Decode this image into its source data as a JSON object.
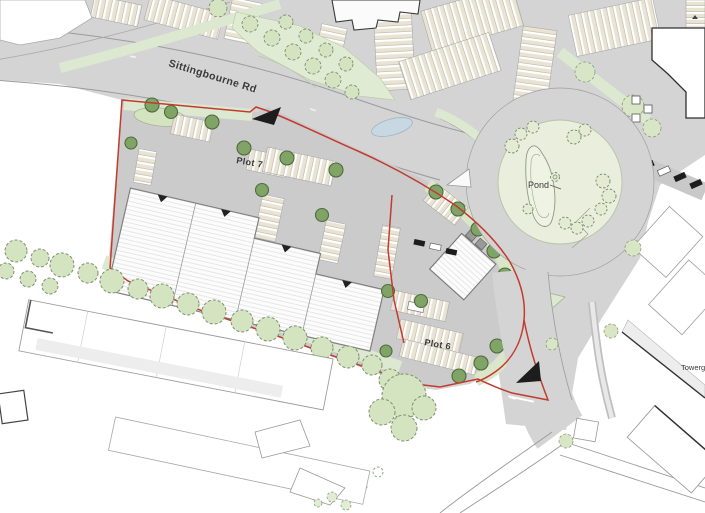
{
  "page": {
    "title": "Site plan"
  },
  "labels": {
    "road_name": "Sittingbourne Rd",
    "plot7": "Plot 7",
    "plot6": "Plot 6",
    "pond": "Pond",
    "edge_building": "Towerga"
  },
  "icons": {
    "entrance_arrow": "traffic-direction-arrow",
    "exit_arrow": "traffic-direction-arrow",
    "tree_dark": "tree-icon",
    "tree_sketch": "tree-outline-icon"
  },
  "colors": {
    "background": "#ffffff",
    "road": "#d4d4d4",
    "site_yard": "#cbcbcb",
    "parking_stall": "#e9e3d4",
    "verge_green": "#dce8cf",
    "pond_green": "#e9efdc",
    "tree_dark_green": "#7fa465",
    "tree_light_green": "#d4e3c0",
    "boundary_red": "#c23b2e",
    "arrow_black": "#1d1d1d",
    "water_blue": "#c7d8e3"
  }
}
